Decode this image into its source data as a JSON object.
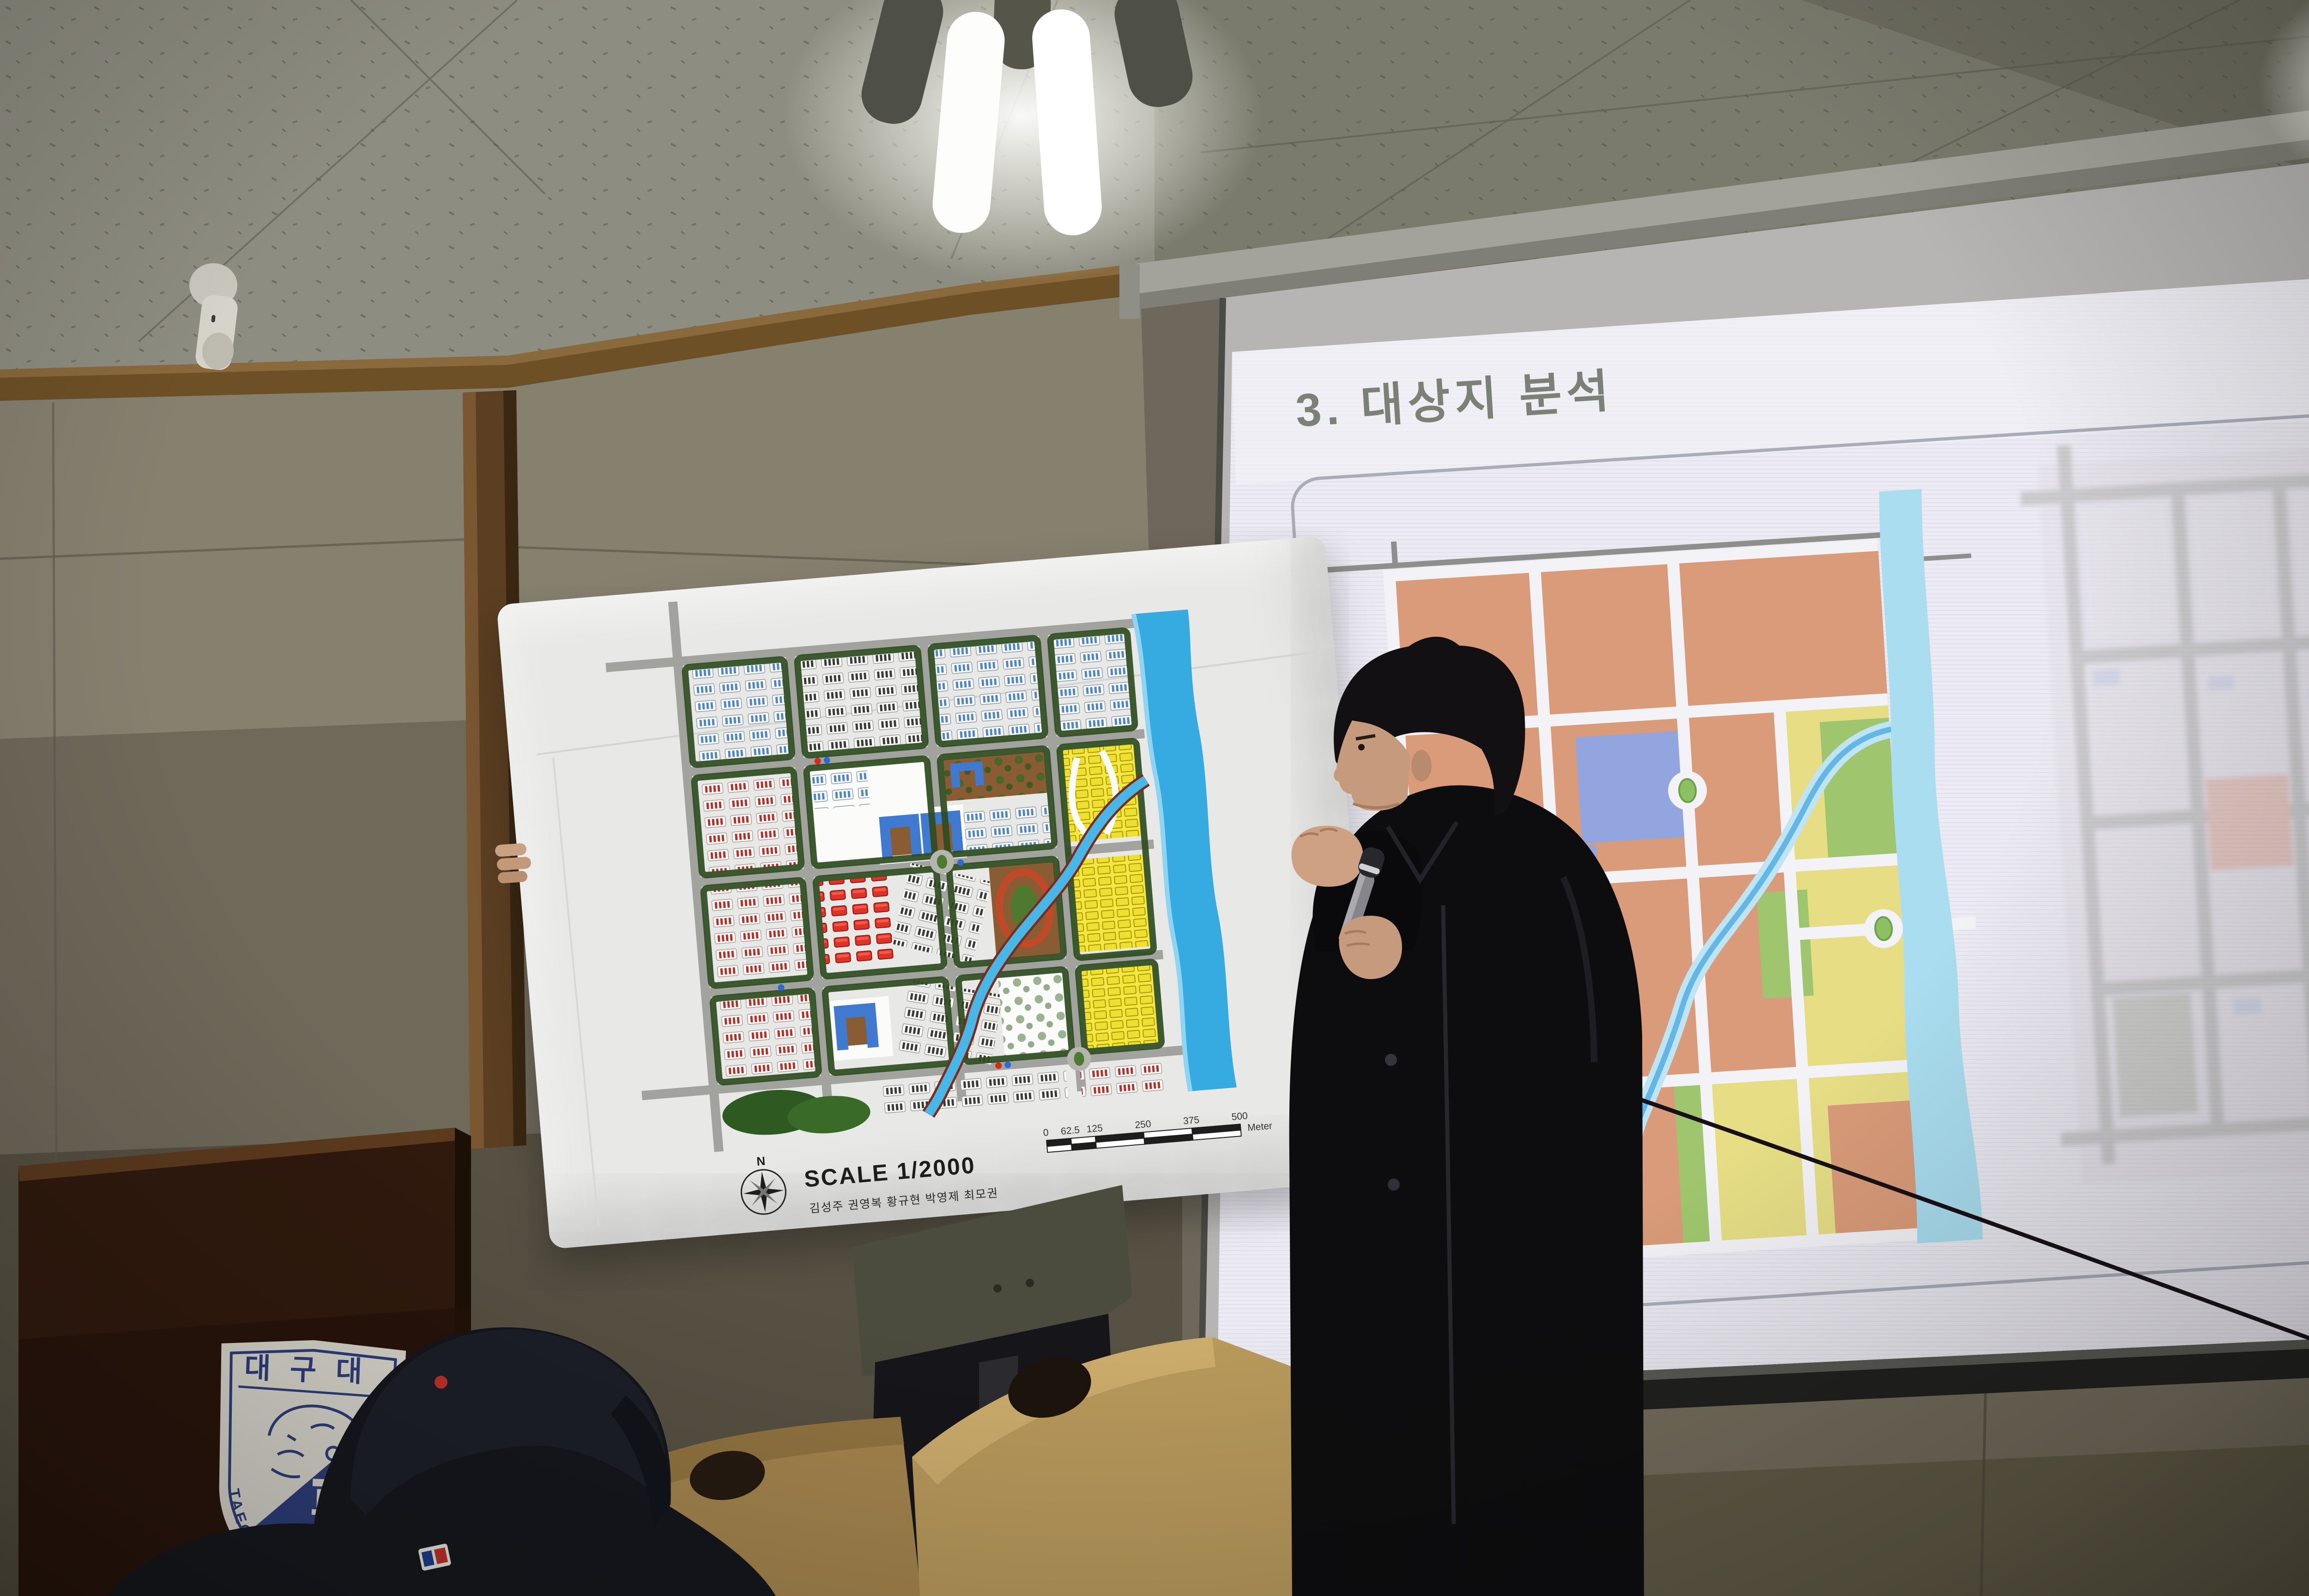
{
  "slide": {
    "title": "3. 대상지 분석"
  },
  "poster": {
    "scale_label": "SCALE 1/2000",
    "authors": "김성주 권영복 황규현 박영제 최모권",
    "compass_label": "N",
    "scalebar": {
      "ticks": [
        "0",
        "62.5",
        "125",
        "250",
        "375",
        "500"
      ],
      "unit": "Meter"
    }
  },
  "podium": {
    "emblem_top": "대구대",
    "emblem_year": "1956",
    "emblem_arc": "TAEGU UNIV"
  },
  "colors": {
    "slide_background": "#eceaf2",
    "slide_title_text": "#7b8174",
    "landuse_residential": "#d99b79",
    "landuse_school": "#93a5de",
    "landuse_commercial": "#e6dd85",
    "landuse_park": "#9fc66e",
    "landuse_river": "#a9ddef",
    "landuse_road": "#f3f2f7",
    "poster_board": "#e8e8e6",
    "poster_red_block": "#e03226",
    "poster_yellow_block": "#efdf2e",
    "poster_blue_building": "#4f86c6",
    "poster_river": "#35abe2",
    "poster_hedge": "#2e4c1f",
    "poster_road": "#a2a29e",
    "wall": "#8f897b",
    "ceiling": "#8e8d81",
    "wood_trim": "#6e5026",
    "podium_wood": "#30190d",
    "chair_wood": "#b99a5c",
    "coat": "#0d0d0f",
    "jeans": "#232e47",
    "emblem_navy": "#2c3d7a"
  }
}
